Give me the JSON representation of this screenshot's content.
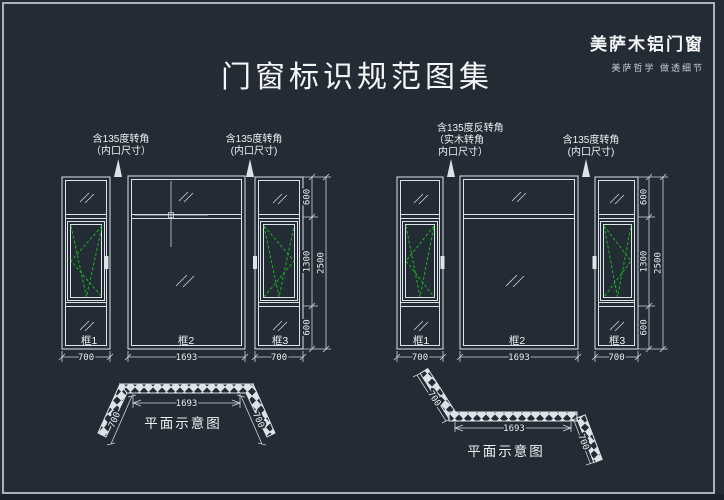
{
  "title": "门窗标识规范图集",
  "brand": {
    "name": "美萨木铝门窗",
    "slogan": "美萨哲学 做透细节"
  },
  "colors": {
    "background": "#232b34",
    "line": "#dde3e8",
    "sash_symbol_green": "#1bb41b",
    "page_border": "#a9b0bc"
  },
  "left_drawing": {
    "label_left_line1": "含135度转角",
    "label_left_line2": "（内口尺寸）",
    "label_right_line1": "含135度转角",
    "label_right_line2": "(内口尺寸)",
    "frame1": "框1",
    "frame2": "框2",
    "frame3": "框3",
    "dim_w1": "700",
    "dim_w2": "1693",
    "dim_w3": "700",
    "dim_h_top": "600",
    "dim_h_mid": "1300",
    "dim_h_bottom": "600",
    "dim_h_total": "2500",
    "plan": {
      "dim_mid": "1693",
      "dim_left_leg": "700",
      "dim_right_leg": "700",
      "caption": "平面示意图"
    }
  },
  "right_drawing": {
    "label_left_line1": "含135度反转角",
    "label_left_line2": "（实木转角",
    "label_left_line3": "内口尺寸）",
    "label_right_line1": "含135度转角",
    "label_right_line2": "(内口尺寸)",
    "frame1": "框1",
    "frame2": "框2",
    "frame3": "框3",
    "dim_w1": "700",
    "dim_w2": "1693",
    "dim_w3": "700",
    "dim_h_top": "600",
    "dim_h_mid": "1300",
    "dim_h_bottom": "600",
    "dim_h_total": "2500",
    "plan": {
      "dim_mid": "1693",
      "dim_left_leg": "700",
      "dim_right_leg": "700",
      "caption": "平面示意图"
    }
  }
}
